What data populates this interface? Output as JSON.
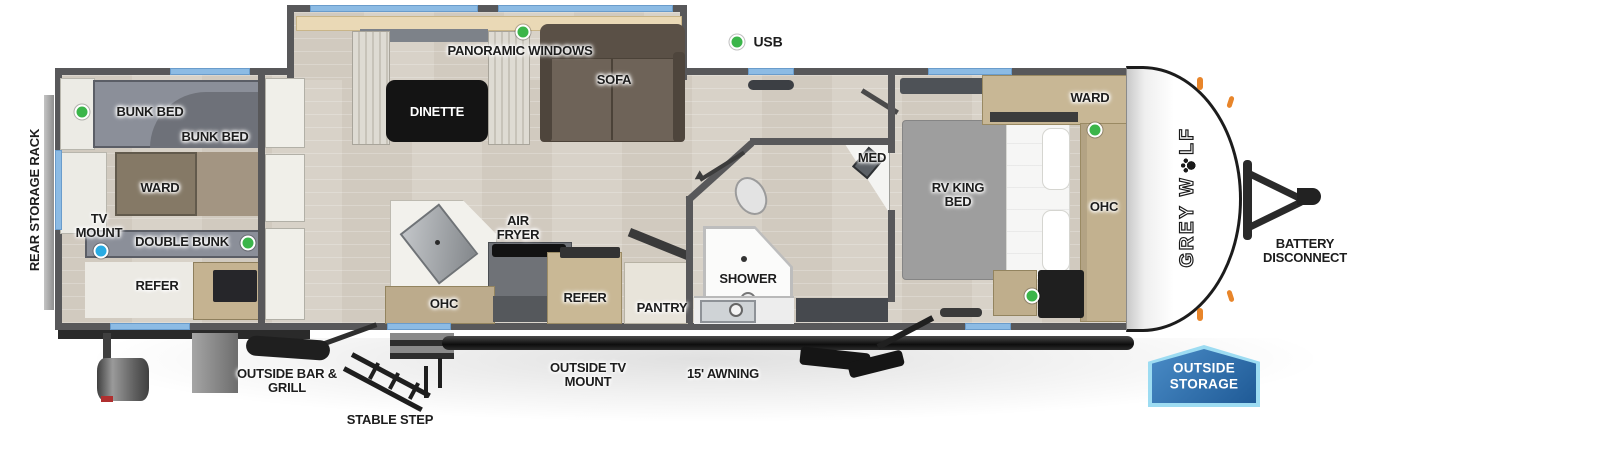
{
  "legend": {
    "usb": "USB"
  },
  "brand": {
    "full": "GREY WOLF",
    "pre": "GREY W",
    "post": "LF"
  },
  "exterior": {
    "rear_storage_rack": "REAR STORAGE RACK",
    "battery_disconnect": "BATTERY DISCONNECT",
    "outside_bar_grill": "OUTSIDE BAR & GRILL",
    "stable_step": "STABLE STEP",
    "outside_tv_mount": "OUTSIDE TV MOUNT",
    "awning": "15' AWNING",
    "outside_storage": "OUTSIDE STORAGE"
  },
  "rooms": {
    "bunk_room": {
      "bunk_bed_upper": "BUNK BED",
      "bunk_bed_lower": "BUNK BED",
      "ward": "WARD",
      "tv_mount": "TV MOUNT",
      "double_bunk": "DOUBLE BUNK",
      "refer": "REFER"
    },
    "living": {
      "panoramic_windows": "PANORAMIC WINDOWS",
      "dinette": "DINETTE",
      "sofa": "SOFA"
    },
    "kitchen": {
      "air_fryer": "AIR FRYER",
      "ohc": "OHC",
      "refer": "REFER",
      "pantry": "PANTRY"
    },
    "bathroom": {
      "shower": "SHOWER",
      "med": "MED"
    },
    "bedroom": {
      "ward": "WARD",
      "rv_king_bed": "RV KING BED",
      "ohc": "OHC"
    }
  },
  "colors": {
    "window_blue": "#8cbbe4",
    "usb_green": "#3bb54a",
    "tv_mount_blue": "#29abe2",
    "wall_gray": "#58585a",
    "badge_blue": "#2b6ba8",
    "badge_border": "#9ddcf2"
  }
}
